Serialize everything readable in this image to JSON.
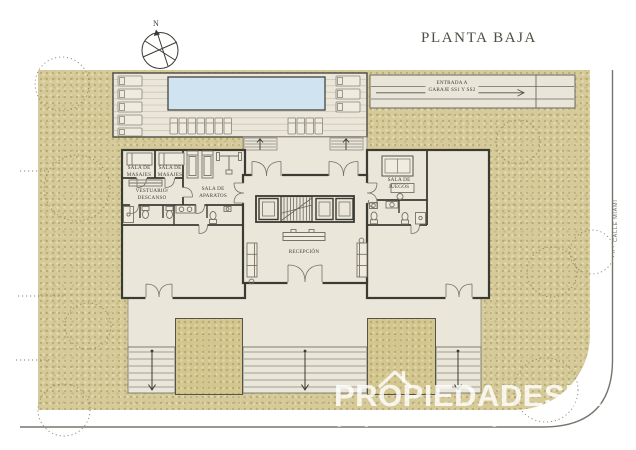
{
  "title": "PLANTA BAJA",
  "compass": {
    "north": "N"
  },
  "street": {
    "name": "CALLE MIAMI"
  },
  "ramp": {
    "line1": "ENTRADA A",
    "line2": "GARAJE SS1 Y SS2"
  },
  "rooms": {
    "masajes1": {
      "l1": "SALA DE",
      "l2": "MASAJES"
    },
    "masajes2": {
      "l1": "SALA DE",
      "l2": "MASAJES"
    },
    "vestuario": {
      "l1": "VESTUARIO/",
      "l2": "DESCANSO"
    },
    "aparatos": {
      "l1": "SALA DE",
      "l2": "APARATOS"
    },
    "juegos": {
      "l1": "SALA DE",
      "l2": "JUEGOS"
    },
    "recepcion": "RECEPCIÓN"
  },
  "watermark": {
    "brand": "PROPIEDADESUY",
    "site": "propiedades.com.uy"
  },
  "colors": {
    "ground": "#d6cb98",
    "floor": "#eae6da",
    "pool": "#cfe4f0",
    "wall": "#3b3a33",
    "watermark": "#ffffff"
  }
}
